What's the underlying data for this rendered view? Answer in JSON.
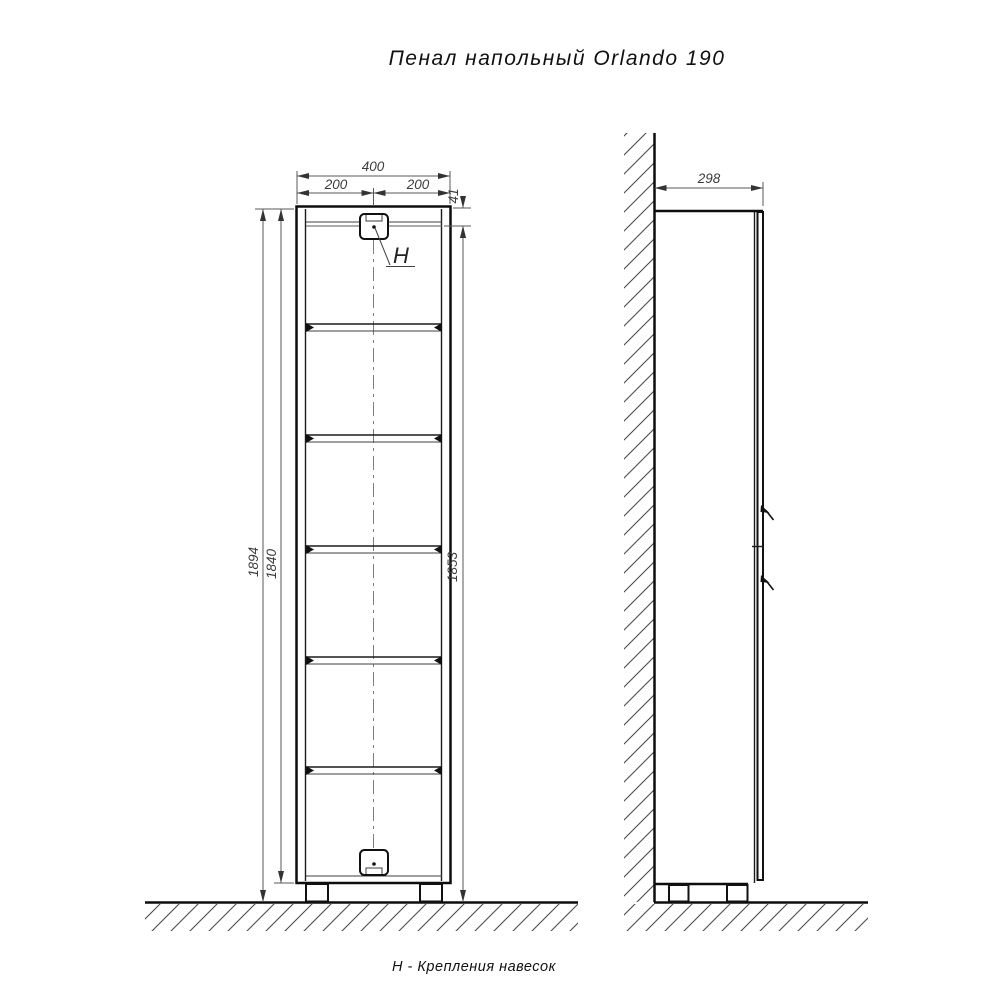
{
  "title": "Пенал напольный Orlando 190",
  "footnote": "Н - Крепления навесок",
  "front_view": {
    "dim_width_total": "400",
    "dim_width_left": "200",
    "dim_width_right": "200",
    "dim_top_offset": "41",
    "dim_height_overall": "1894",
    "dim_height_body": "1840",
    "dim_bracket_to_floor": "1853",
    "bracket_label": "H"
  },
  "side_view": {
    "dim_depth": "298"
  },
  "colors": {
    "line": "#0d0d0d",
    "dimension": "#5a5a5a",
    "hatch": "#4a4a4a"
  }
}
